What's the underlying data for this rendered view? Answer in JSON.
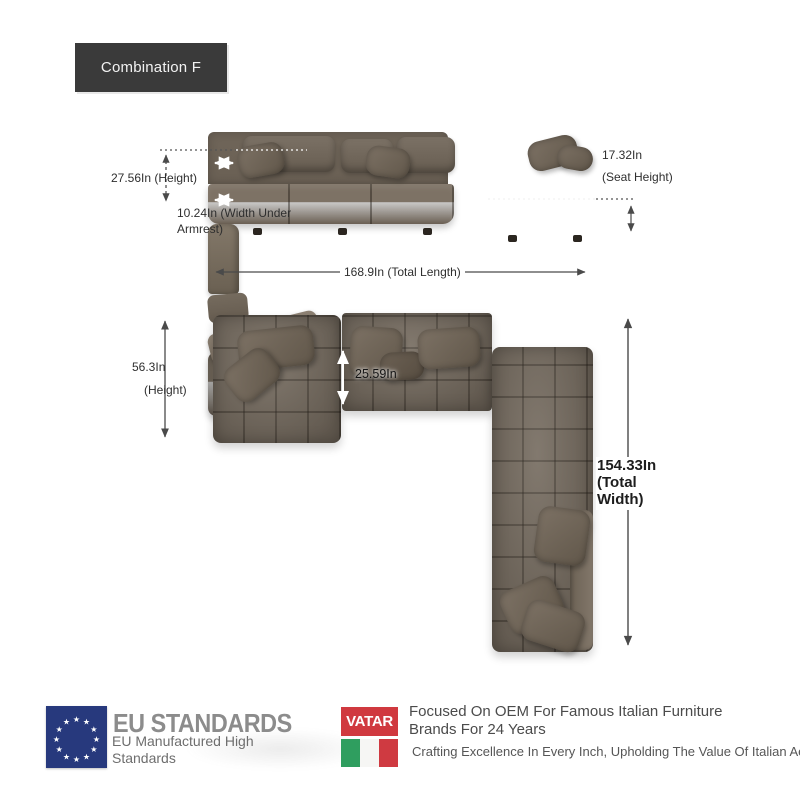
{
  "badge": {
    "label": "Combination F"
  },
  "front_view": {
    "height": "27.56In (Height)",
    "width_under_armrest": "10.24In (Width Under Armrest)",
    "seat_height_value": "17.32In",
    "seat_height_label": "(Seat Height)",
    "total_length": "168.9In (Total Length)"
  },
  "top_view": {
    "height_value": "56.3In",
    "height_label": "(Height)",
    "seat_depth": "25.59In",
    "total_width": {
      "line1": "154.33In",
      "line2": "(Total",
      "line3": "Width)"
    }
  },
  "footer": {
    "eu_title": "EU STANDARDS",
    "eu_subtitle": "EU Manufactured High Standards",
    "vatar_logo": "VATAR",
    "oem_headline": "Focused On OEM For Famous Italian Furniture Brands For 24 Years",
    "tagline": "Crafting Excellence In Every Inch, Upholding The Value Of Italian Aesthet"
  },
  "icons": {
    "eu_flag": "circle-of-stars-flag",
    "italy_flag": "italian-tricolor-flag",
    "dimension_arrows": "double-headed-arrows"
  },
  "colors": {
    "badge_bg": "#3a3a3a",
    "sofa_base": "#746a5e",
    "sofa_shadow": "#5e564b",
    "pillow": "#6b6154",
    "dimension_line": "#4a4a4a",
    "eu_flag_blue": "#27397d",
    "eu_text_gray": "#8c8c8c",
    "vatar_red": "#d0393f",
    "flag_green": "#2f9e5f",
    "flag_red": "#cf3a41"
  }
}
